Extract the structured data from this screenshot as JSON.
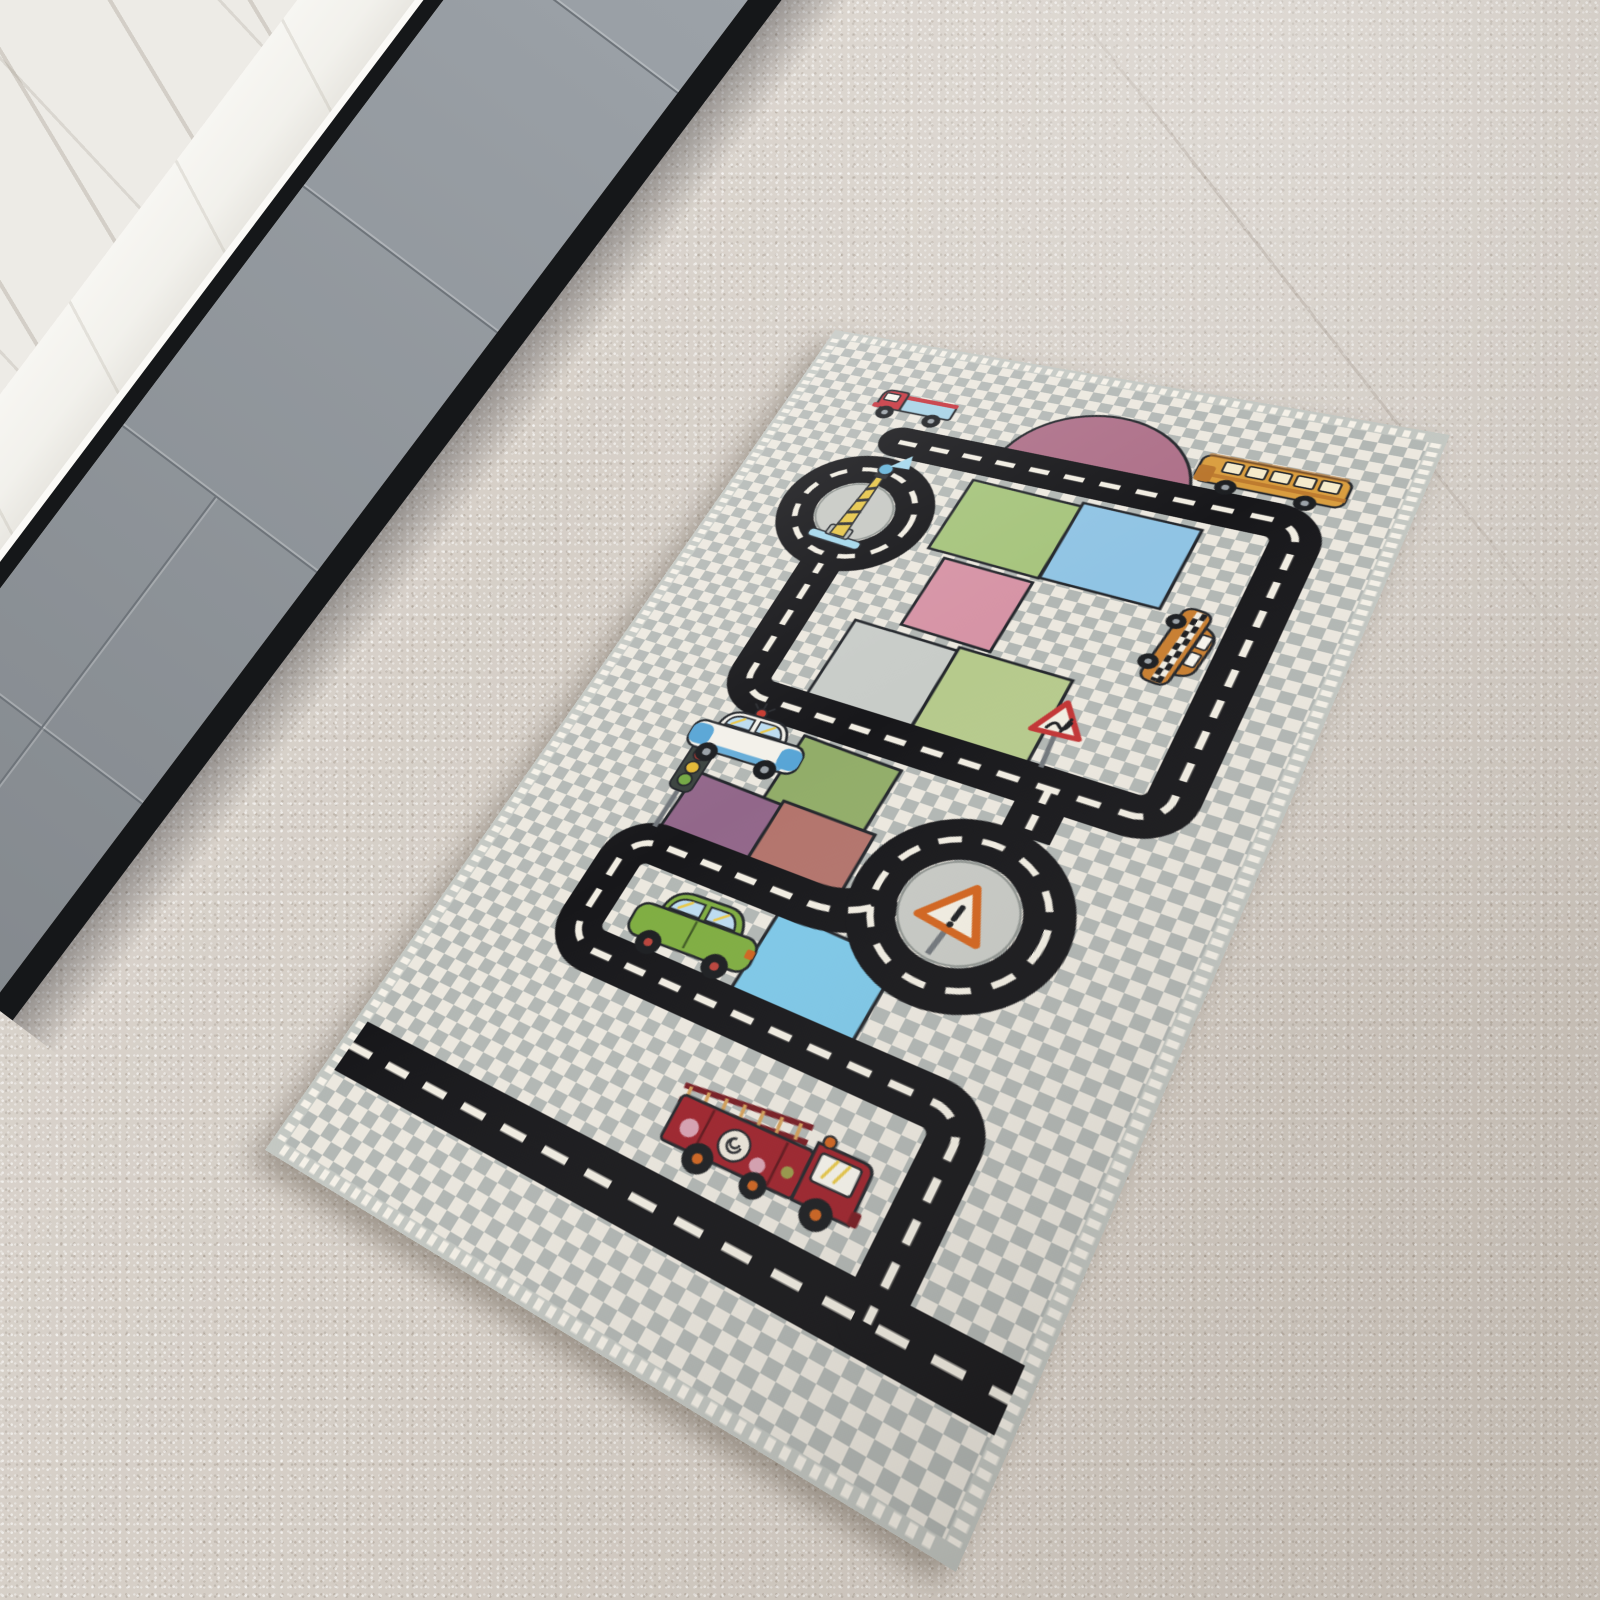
{
  "scene": {
    "description": "Photograph of a children's city-traffic play rug lying diagonally on a beige speckled carpet, next to gray flat-front kitchen cabinets with a white marble countertop and chrome faucet in the upper-left corner.",
    "floor_label": "beige carpet floor",
    "kitchen": {
      "label": "kitchen corner",
      "wall_label": "white marble wall",
      "countertop_label": "white marble countertop",
      "faucet_label": "chrome faucet handles",
      "cabinets_label": "gray handleless cabinet doors",
      "toe_kick_label": "black toe kick"
    },
    "rug": {
      "label": "kids road-traffic play rug",
      "field_label": "gray and white checkerboard field",
      "fringe_label": "white fringed edge",
      "dome_label": "dusty-pink dome hill",
      "road_label": "black road loop with white dashed lane markings",
      "bottom_road_label": "road band along bottom edge",
      "roundabouts": [
        {
          "id": "lighthouse-roundabout",
          "label": "roundabout with striped lighthouse"
        },
        {
          "id": "sign-roundabout",
          "label": "roundabout with orange warning triangle"
        }
      ],
      "plots": [
        {
          "id": "plot-green",
          "label": "green plot"
        },
        {
          "id": "plot-blue",
          "label": "light blue plot"
        },
        {
          "id": "plot-pink",
          "label": "pink plot"
        },
        {
          "id": "plot-gray",
          "label": "light gray plot"
        },
        {
          "id": "plot-lightgreen",
          "label": "light green plot"
        },
        {
          "id": "plot-midgreen",
          "label": "mid green plot"
        },
        {
          "id": "plot-purple",
          "label": "purple plot"
        },
        {
          "id": "plot-terracotta",
          "label": "terracotta plot"
        },
        {
          "id": "plot-pond",
          "label": "bright blue pond plot"
        }
      ],
      "vehicles": [
        {
          "id": "pickup-truck",
          "label": "red pickup truck with light blue bed"
        },
        {
          "id": "school-bus",
          "label": "orange-yellow school bus"
        },
        {
          "id": "taxi",
          "label": "orange taxi with checker stripe"
        },
        {
          "id": "police-car",
          "label": "white and blue police car with red beacon"
        },
        {
          "id": "green-car",
          "label": "green car"
        },
        {
          "id": "fire-truck",
          "label": "dark red fire truck with ladder"
        }
      ],
      "props": [
        {
          "id": "traffic-light",
          "label": "traffic light with red, yellow and green lamps"
        },
        {
          "id": "warning-sign",
          "label": "red-bordered triangular bump sign"
        },
        {
          "id": "roundabout-sign",
          "label": "orange-bordered triangular exclamation sign"
        },
        {
          "id": "lighthouse",
          "label": "yellow-black striped lighthouse on blue base"
        }
      ]
    },
    "colors": {
      "floor": "#d5cec6",
      "marbleWall": "#edebe6",
      "counter": "#f2f1ec",
      "cabinet": "#9aa0a6",
      "cabinetSeam": "#6e747a",
      "toeKick": "#151719",
      "chrome": "#34393f",
      "chromeLight": "#d6dade",
      "checkGray": "#b2b7b4",
      "checkWhite": "#ece8df",
      "binding": "#c3c7c2",
      "fringe": "#f5f1e8",
      "road": "#17171a",
      "roadDash": "#f1ede2",
      "island": "#c7c9c4",
      "dome": "#ad6f88",
      "outline": "#23262b",
      "plotGreen": "#a6c47c",
      "plotBlue": "#90c4e4",
      "plotPink": "#d693a5",
      "plotGray": "#c8ccc8",
      "plotLtGreen": "#b6ca8c",
      "plotMidGreen": "#92ad69",
      "plotPurple": "#92678a",
      "plotTerra": "#b3746c",
      "pond": "#7ec8e8",
      "truckRed": "#c5333c",
      "truckBed": "#a6d2e6",
      "busYellow": "#d99d3e",
      "busDark": "#b9752c",
      "busWindow": "#f5ebcb",
      "taxiOrange": "#c87e30",
      "policeWhite": "#f3f1ea",
      "policeBlue": "#58a5d6",
      "carGreen": "#7fad41",
      "fireRed": "#9e232c",
      "fireDark": "#771b22",
      "windowBlue": "#bddcf0",
      "windowStreak": "#e8c84a",
      "wheel": "#1c1e21",
      "hub": "#9aa1a7",
      "hubOrange": "#cf6420",
      "lighthouseYellow": "#e6c64a",
      "lightBlue": "#66b4da",
      "paleBlue": "#a5d8ec",
      "signalRed": "#c43a30",
      "signalYellow": "#e2b836",
      "signalGreen": "#74a844",
      "signRed": "#c23434",
      "signOrange": "#d2641e",
      "signFace": "#f2eee2",
      "pole": "#71767b"
    }
  }
}
